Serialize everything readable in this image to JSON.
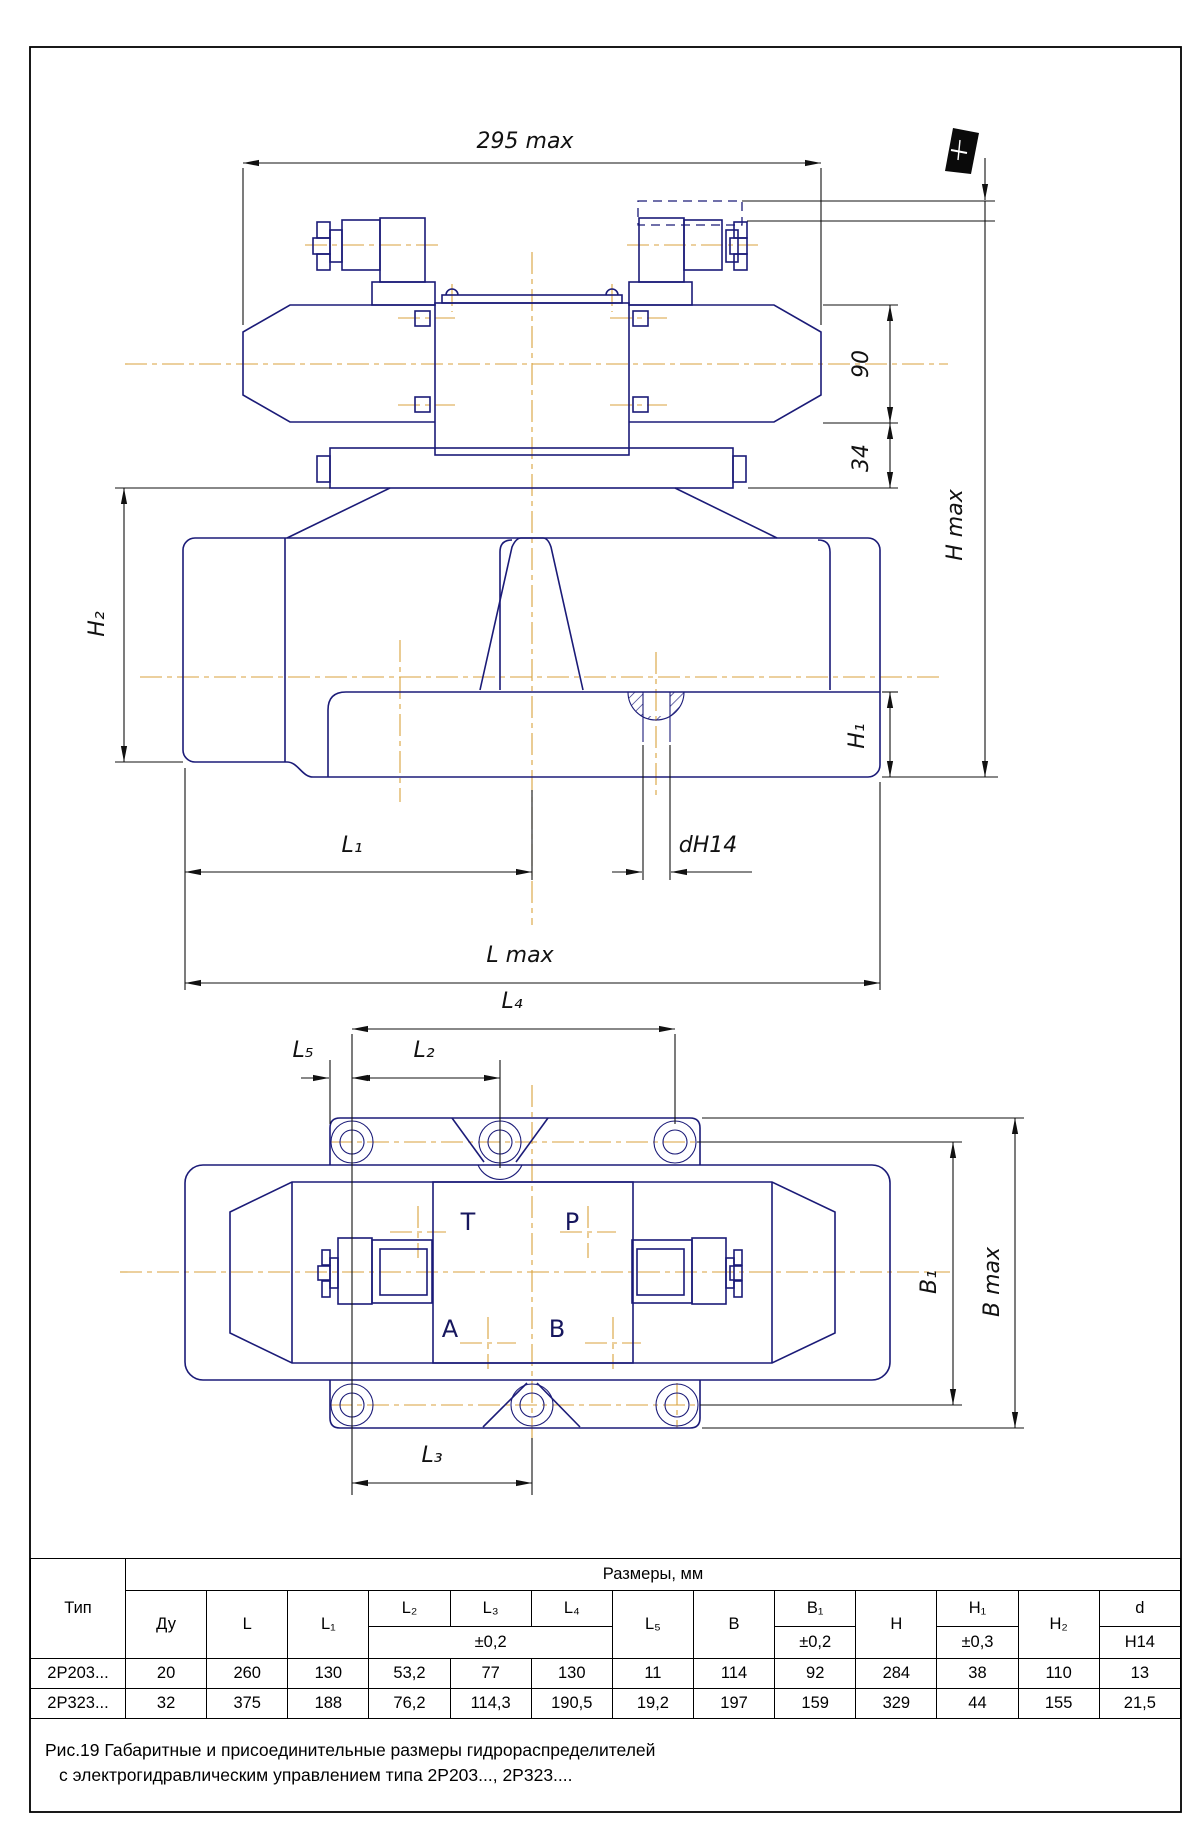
{
  "colors": {
    "line": "#1b1b78",
    "centerline": "#d9a23c",
    "dimension": "#111111"
  },
  "front_view": {
    "dims": {
      "width_max": "295 max",
      "d90": "90",
      "d34": "34",
      "h_max": "H max",
      "h2": "H₂",
      "h1": "H₁",
      "l1": "L₁",
      "l_max": "L max",
      "dh14": "dH14"
    }
  },
  "top_view": {
    "dims": {
      "l4": "L₄",
      "l5": "L₅",
      "l2": "L₂",
      "l3": "L₃",
      "b1": "B₁",
      "b_max": "B max"
    },
    "ports": {
      "t": "T",
      "p": "P",
      "a": "A",
      "b": "B"
    }
  },
  "table": {
    "size_title": "Размеры, мм",
    "col_type": "Тип",
    "cols": {
      "du": "Ду",
      "l": "L",
      "l1": "L₁",
      "l2": "L₂",
      "l3": "L₃",
      "l4": "L₄",
      "l5": "L₅",
      "b": "B",
      "b1": "B₁",
      "h": "H",
      "h1": "H₁",
      "h2": "H₂",
      "d": "d"
    },
    "tol_l": "±0,2",
    "tol_b1": "±0,2",
    "tol_h1": "±0,3",
    "tol_d": "H14",
    "rows": [
      {
        "type": "2Р203...",
        "du": "20",
        "l": "260",
        "l1": "130",
        "l2": "53,2",
        "l3": "77",
        "l4": "130",
        "l5": "11",
        "b": "114",
        "b1": "92",
        "h": "284",
        "h1": "38",
        "h2": "110",
        "d": "13"
      },
      {
        "type": "2Р323...",
        "du": "32",
        "l": "375",
        "l1": "188",
        "l2": "76,2",
        "l3": "114,3",
        "l4": "190,5",
        "l5": "19,2",
        "b": "197",
        "b1": "159",
        "h": "329",
        "h1": "44",
        "h2": "155",
        "d": "21,5"
      }
    ]
  },
  "caption": {
    "line1": "Рис.19   Габаритные и присоединительные размеры гидрораспределителей",
    "line2": "с электрогидравлическим управлением типа 2Р203..., 2Р323...."
  }
}
